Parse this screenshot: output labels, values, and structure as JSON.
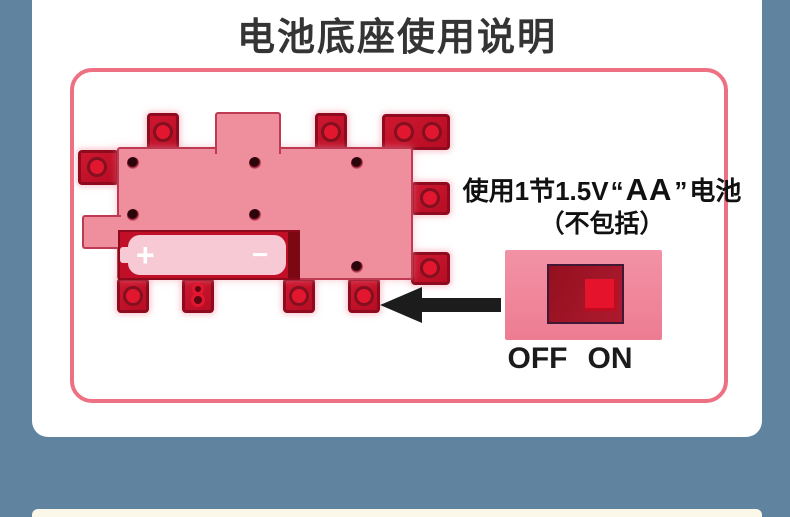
{
  "title": "电池底座使用说明",
  "battery_info": {
    "prefix": "使用1节1.5V",
    "open_quote": "“",
    "type": "AA",
    "close_quote": "”",
    "suffix": "电池",
    "note": "（不包括）"
  },
  "battery": {
    "plus": "+",
    "minus": "−"
  },
  "switch": {
    "off_label": "OFF",
    "on_label": "ON"
  },
  "colors": {
    "page_background": "#60839F",
    "card_background": "#FFFFFF",
    "frame_border": "#EE7183",
    "base_body_pink": "#EF8E9D",
    "tab_red": "#C5102A",
    "stud_red": "#E2172F",
    "battery_pink": "#F7C9D5",
    "compartment_red": "#C20F28",
    "switch_plate_pink": "#F18AA0",
    "switch_recess_red": "#9C1224",
    "switch_knob_red": "#E5142C",
    "arrow_black": "#1C1C1C",
    "title_text": "#343434"
  }
}
